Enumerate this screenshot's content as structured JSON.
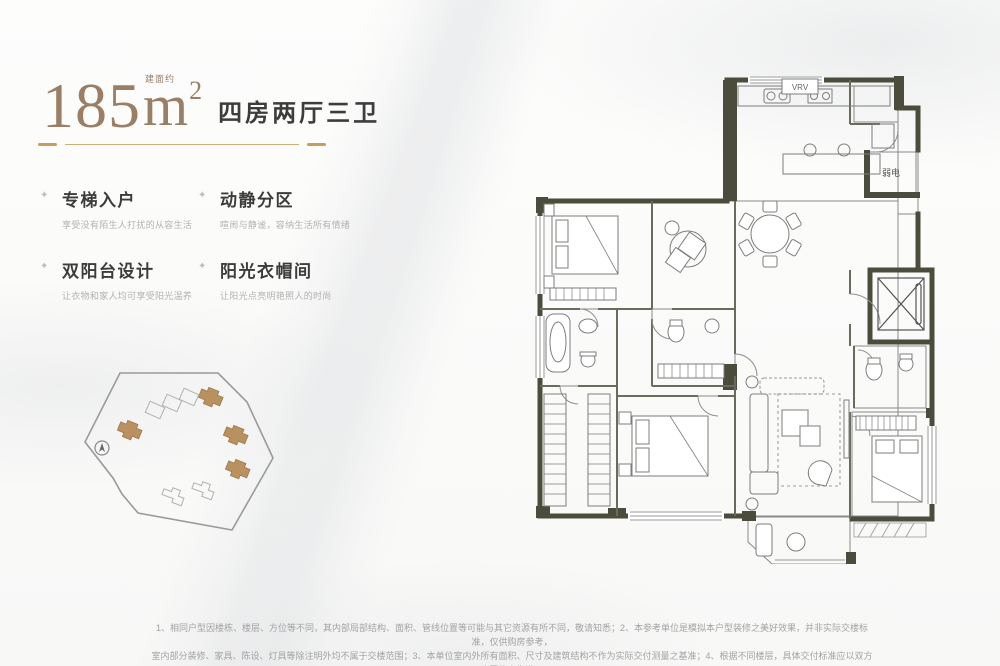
{
  "header": {
    "area_value": "185",
    "area_prefix": "建面约",
    "area_unit": "m",
    "area_sup": "2",
    "layout_label": "四房两厅三卫",
    "accent_color": "#c59d60",
    "title_color": "#9a7f66"
  },
  "features": [
    {
      "title": "专梯入户",
      "desc": "享受没有陌生人打扰的从容生活"
    },
    {
      "title": "动静分区",
      "desc": "喧闹与静谧，容纳生活所有情绪"
    },
    {
      "title": "双阳台设计",
      "desc": "让衣物和家人均可享受阳光温养"
    },
    {
      "title": "阳光衣帽间",
      "desc": "让阳光点亮明艳照人的时尚"
    }
  ],
  "floor_plan": {
    "labels": {
      "vrv": "VRV",
      "weak_electric": "弱电"
    },
    "wall_color": "#4b4c3b",
    "line_color": "#8a8a8a"
  },
  "site_plan": {
    "building_color": "#b9905f",
    "outline_color": "#9a9a9a"
  },
  "disclaimer": {
    "line1": "1、相同户型因楼栋、楼层、方位等不同，其内部局部结构、面积、管线位置等可能与其它资源有所不同，敬请知悉；2、本参考单位是模拟本户型装修之美好效果，并非实际交楼标准，仅供购房参考，",
    "line2": "室内部分装修、家具、陈设、灯具等除注明外均不属于交楼范围；3、本单位室内外所有面积、尺寸及建筑结构不作为实际交付测量之基准；4、根据不同楼层，具体交付标准应以双方合同约定为准。"
  }
}
